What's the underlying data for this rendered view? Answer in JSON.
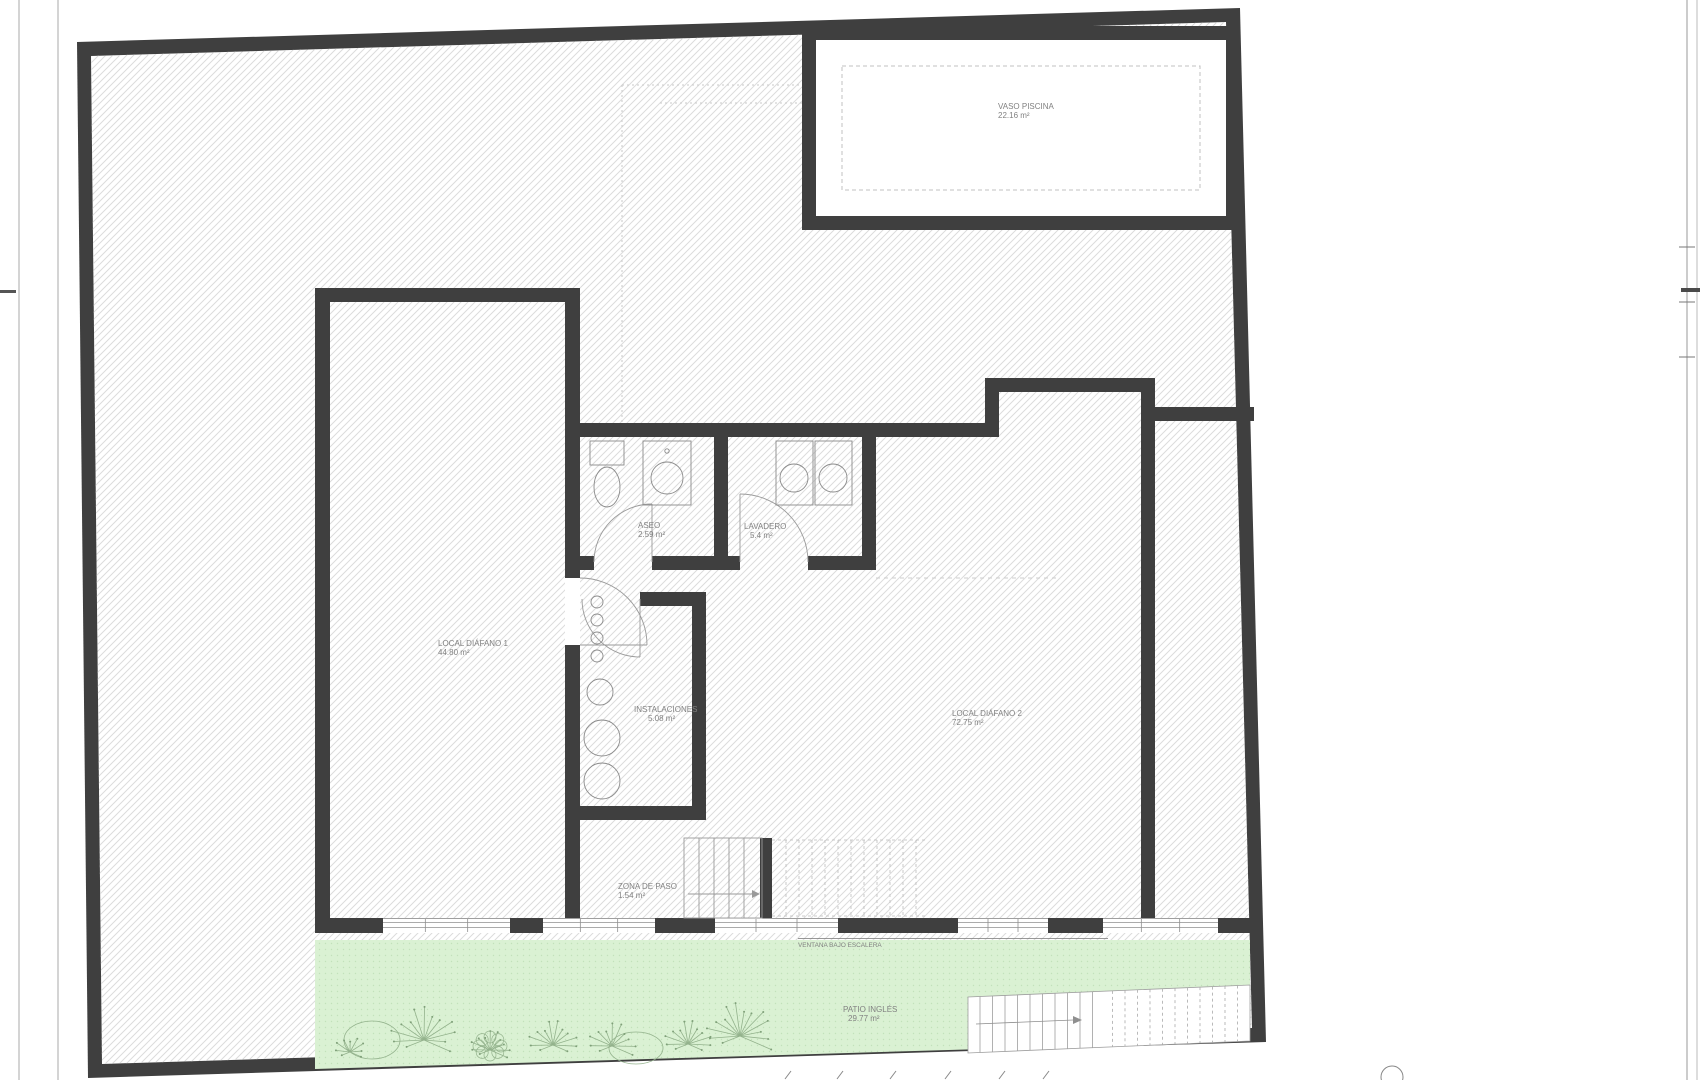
{
  "drawing": {
    "rooms": {
      "vaso_piscina": {
        "name": "VASO PISCINA",
        "area": "22.16 m²"
      },
      "local_diafano_1": {
        "name": "LOCAL DIÁFANO 1",
        "area": "44.80 m²"
      },
      "local_diafano_2": {
        "name": "LOCAL DIÁFANO 2",
        "area": "72.75 m²"
      },
      "instalaciones": {
        "name": "INSTALACIONES",
        "area": "5.08 m²"
      },
      "aseo": {
        "name": "ASEO",
        "area": "2.59 m²"
      },
      "lavadero": {
        "name": "LAVADERO",
        "area": "5.4 m²"
      },
      "zona_de_paso": {
        "name": "ZONA DE PASO",
        "area": "1.54 m²"
      },
      "patio_ingles": {
        "name": "PATIO INGLÉS",
        "area": "29.77 m²"
      }
    },
    "annotations": {
      "ventana_bajo_escalera": "VENTANA BAJO ESCALERA"
    },
    "colors": {
      "wall": "#3f3f3f",
      "hatch_line": "#dcdcdc",
      "patio_green": "#daf1d3",
      "plant_stroke": "#93b28c",
      "thin_line": "#8f8f8f",
      "text": "#818181"
    }
  }
}
